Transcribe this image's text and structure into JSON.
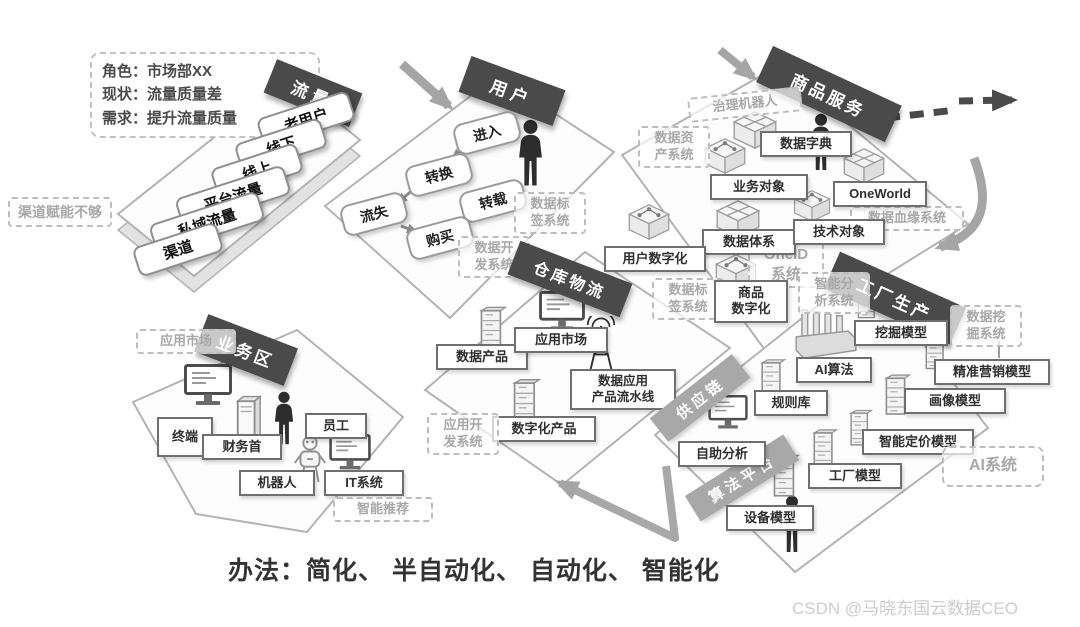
{
  "note_box": {
    "line1": "角色：市场部XX",
    "line2": "现状：流量质量差",
    "line3": "需求：提升流量质量"
  },
  "side_note": "渠道赋能不够",
  "method_line": "办法：简化、 半自动化、 自动化、 智能化",
  "watermark": "CSDN @马晓东国云数据CEO",
  "zones": {
    "traffic": {
      "title": "流量",
      "items": [
        "老用户",
        "线下",
        "线上",
        "平台流量",
        "私域流量",
        "渠道"
      ]
    },
    "user": {
      "title": "用户",
      "enter": "进入",
      "convert": "转换",
      "forward": "转载",
      "churn": "流失",
      "buy": "购买",
      "sys_tag": "数据标\n签系统",
      "sys_dev": "数据开\n发系统"
    },
    "goods": {
      "title": "商品服务",
      "gov_robot": "治理机器人",
      "sys_asset": "数据资\n产系统",
      "sys_lineage": "数据血缘系统",
      "sys_tag": "数据标\n签系统",
      "sys_oneid": "OneID\n系统",
      "dict": "数据字典",
      "biz_obj": "业务对象",
      "oneworld": "OneWorld",
      "data_sys": "数据体系",
      "tech_obj": "技术对象",
      "user_digital": "用户数字化",
      "goods_digital": "商品\n数字化"
    },
    "warehouse": {
      "title": "仓库物流",
      "data_product": "数据产品",
      "app_market": "应用市场",
      "pipeline": "数据应用\n产品流水线",
      "digital_product": "数字化产品",
      "sys_dev": "应用开\n发系统"
    },
    "factory": {
      "title": "工厂生产",
      "supply_chain": "供应链",
      "algo_platform": "算法平台",
      "mining_model": "挖掘模型",
      "ai_algo": "AI算法",
      "rule_lib": "规则库",
      "self_analysis": "自助分析",
      "factory_model": "工厂模型",
      "device_model": "设备模型",
      "marketing_model": "精准营销模型",
      "profile_model": "画像模型",
      "pricing_model": "智能定价模型",
      "sys_analysis": "智能分\n析系统",
      "sys_mining": "数据挖\n掘系统",
      "sys_ai": "AI系统"
    },
    "business": {
      "title": "业务区",
      "terminal": "终端",
      "finance": "财务首",
      "staff": "员工",
      "robot": "机器人",
      "it": "IT系统",
      "sys_market": "应用市场",
      "sys_recommend": "智能推荐"
    }
  },
  "icons": {
    "person-icon": "standing person silhouette",
    "robot-icon": "service robot",
    "monitor-icon": "desktop monitor",
    "server-icon": "server cabinet",
    "antenna-icon": "signal tower",
    "factory-icon": "factory with chimneys",
    "box-x-icon": "isometric parcel box",
    "box-dots-icon": "isometric box with data nodes"
  },
  "colors": {
    "zone_banner": "#4a4a4a",
    "sub_banner": "#a8a8a8",
    "label_border": "#6f6f6f",
    "dashed_border": "#bdbdbd",
    "dashed_text": "#a8a8a8",
    "arrow_gray": "#a5a5a5",
    "arrow_dark": "#4a4a4a",
    "watermark": "#cccccc"
  }
}
